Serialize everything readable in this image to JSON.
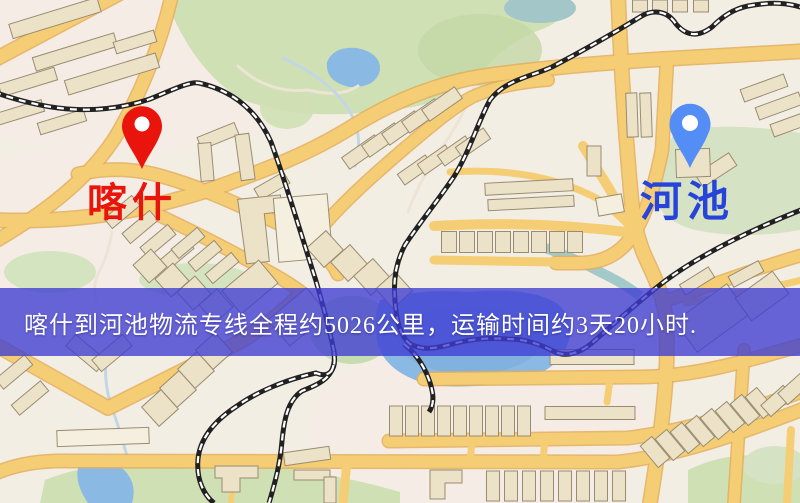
{
  "map": {
    "type": "road-map",
    "palette": {
      "background": "#f3eee3",
      "road": "#f5cd74",
      "road_casing": "#e3ad5b",
      "building": "#ebe2c7",
      "park_green": "#cfe0b4",
      "water_blue": "#8ab9e4",
      "railway": "#212121",
      "banner_blue": "#3e3cd3"
    }
  },
  "markers": {
    "origin": {
      "label": "喀什",
      "label_color": "#e9150d",
      "pin_color": "#e9150d"
    },
    "destination": {
      "label": "河池",
      "label_color": "#2744da",
      "pin_color": "#548df6"
    }
  },
  "route": {
    "from": "喀什",
    "to": "河池",
    "distance": "约5026公里",
    "duration": "约3天20小时"
  },
  "banner": {
    "text": "喀什到河池物流专线全程约5026公里，运输时间约3天20小时.",
    "text_color": "#ffffff",
    "background_color": "#3e3cd3"
  }
}
